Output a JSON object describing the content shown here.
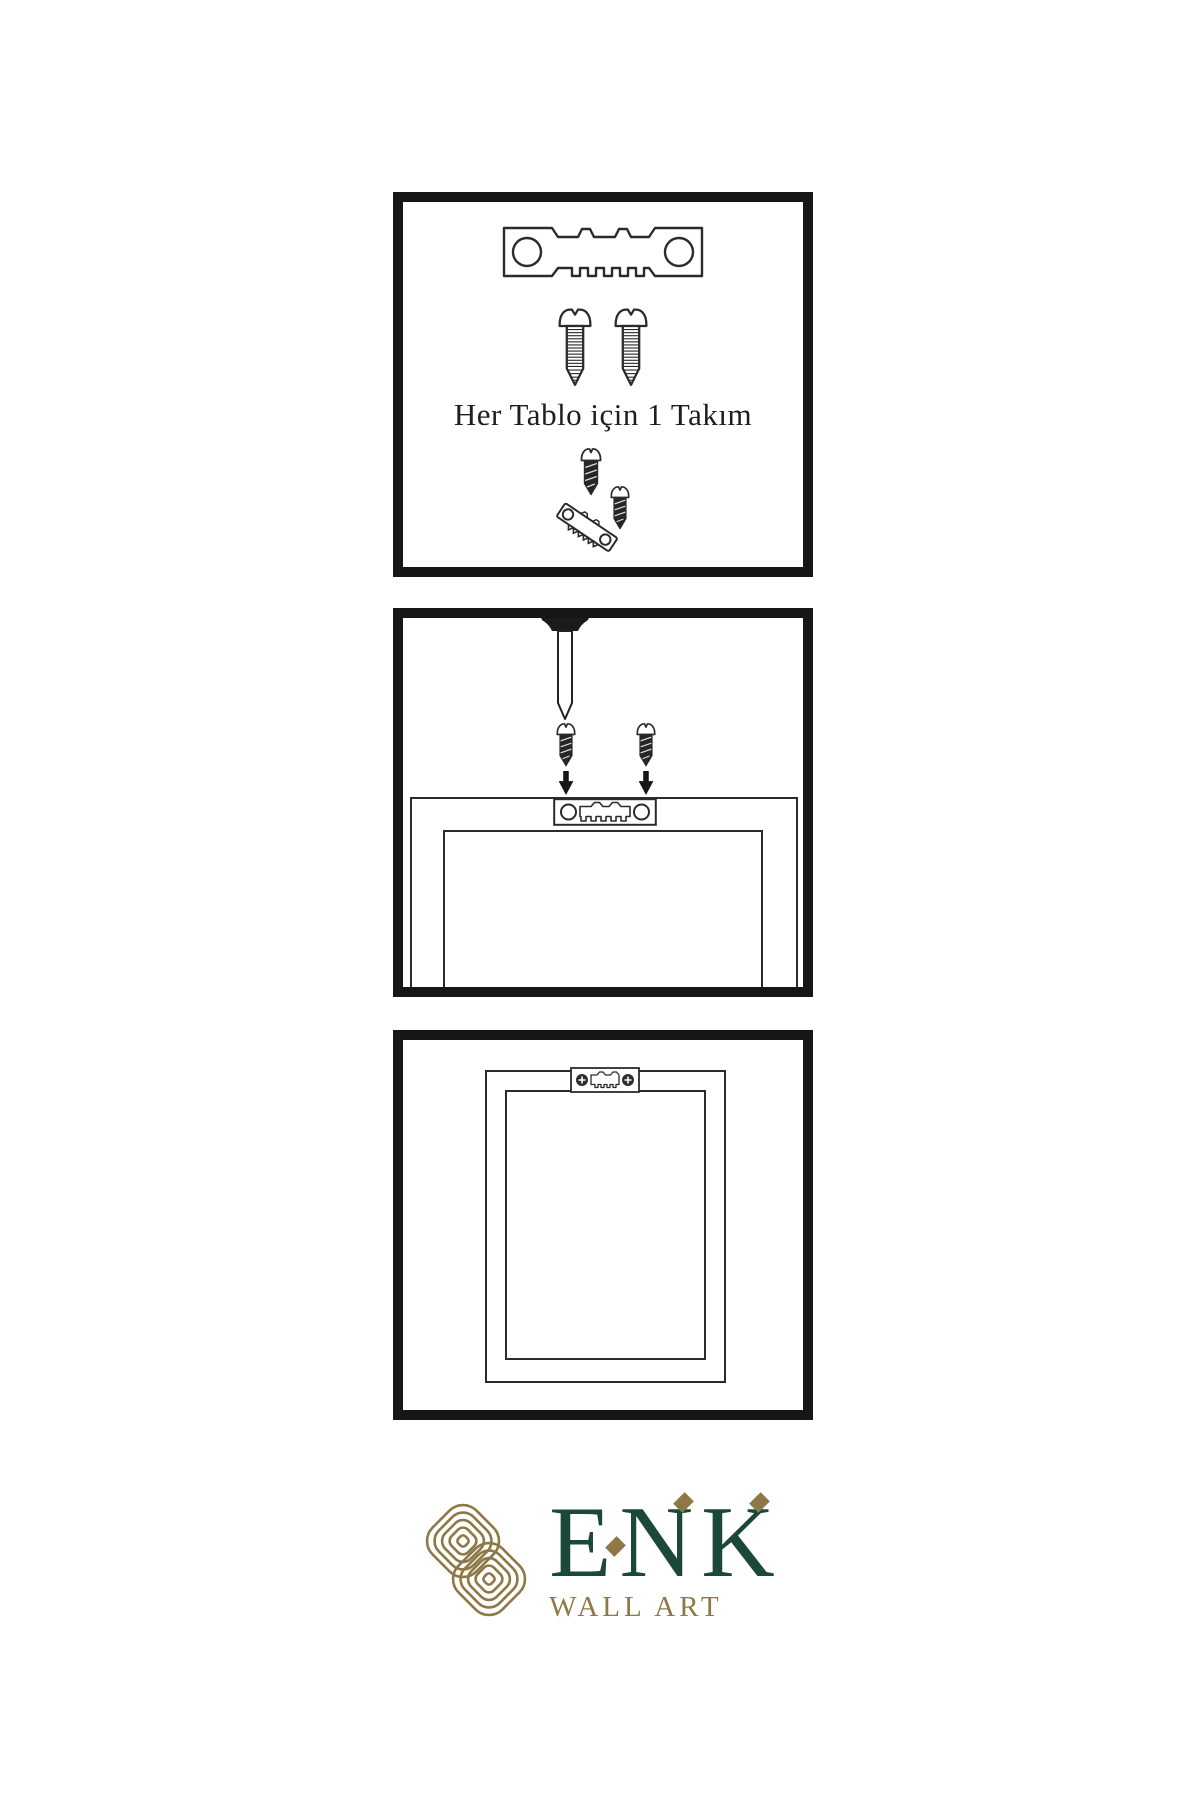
{
  "page": {
    "background": "#ffffff"
  },
  "colors": {
    "paper": "#ffffff",
    "ink": "#161616",
    "line": "#2b2b2b",
    "screw-dark": "#262626",
    "brand-green": "#1c4839",
    "brand-gold": "#8e7845"
  },
  "instructions": {
    "panel1": {
      "caption": "Her Tablo için 1 Takım",
      "icons": [
        "sawtooth-hanger-icon",
        "screw-icon",
        "screw-icon",
        "hanger-mounting-demo-icon"
      ]
    },
    "panel2": {
      "icons": [
        "wall-nail-icon",
        "screw-icon",
        "screw-icon",
        "arrow-down-icon",
        "arrow-down-icon",
        "sawtooth-plate-icon",
        "frame-back-icon"
      ]
    },
    "panel3": {
      "icons": [
        "mounted-sawtooth-plate-icon",
        "frame-back-icon"
      ]
    }
  },
  "logo": {
    "brand": "ENK",
    "subtitle": "WALL ART",
    "icons": [
      "knot-logo-icon"
    ]
  }
}
